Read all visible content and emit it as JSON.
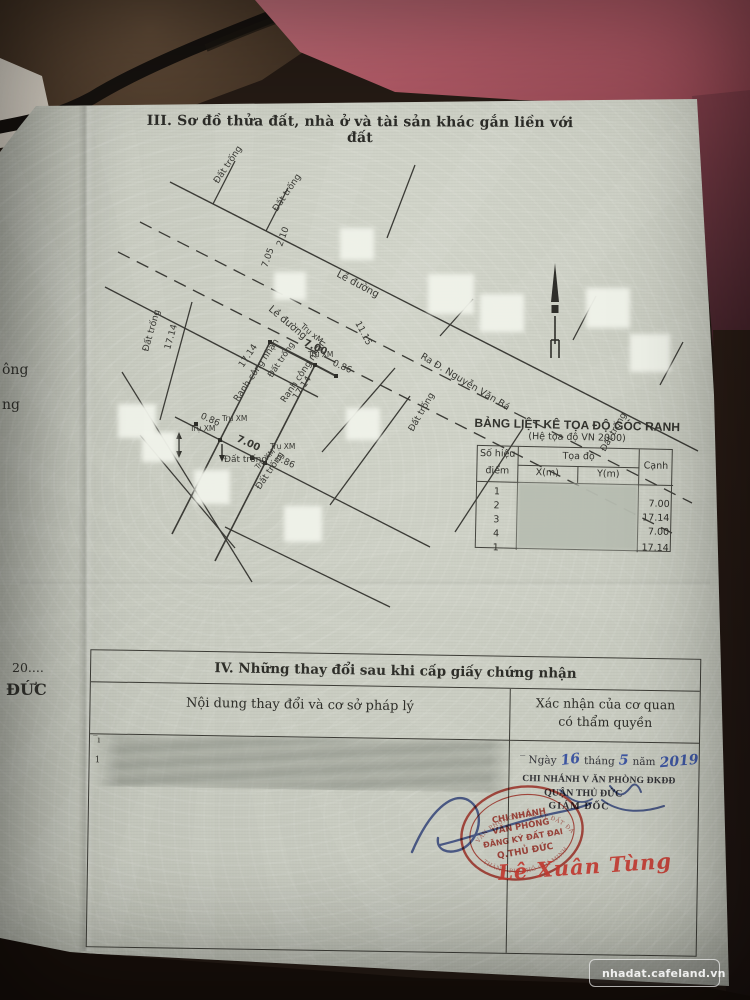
{
  "photo": {
    "watermark_label": "nhadat.cafeland.vn"
  },
  "document": {
    "section3_title": "III. Sơ đồ thửa đất, nhà ở và tài sản khác gắn liền với đất",
    "left_fragments": [
      {
        "t": "ông",
        "x": 2,
        "y": 362,
        "s": 14,
        "b": 0
      },
      {
        "t": "ng",
        "x": 2,
        "y": 397,
        "s": 14,
        "b": 0
      },
      {
        "t": "20....",
        "x": 12,
        "y": 660,
        "s": 12.5,
        "b": 0
      },
      {
        "t": "ĐỨC",
        "x": 6,
        "y": 680,
        "s": 16,
        "b": 1
      }
    ],
    "map": {
      "lines": [
        [
          170,
          182,
          698,
          451,
          0,
          1.4
        ],
        [
          213,
          204,
          235,
          161
        ],
        [
          266,
          231,
          288,
          188
        ],
        [
          415,
          165,
          387,
          238
        ],
        [
          440,
          336,
          473,
          299
        ],
        [
          573,
          340,
          596,
          296
        ],
        [
          660,
          385,
          683,
          342
        ],
        [
          140,
          222,
          692,
          503,
          1,
          1.3
        ],
        [
          118,
          252,
          672,
          533,
          1,
          1.3
        ],
        [
          105,
          287,
          318,
          397,
          0,
          1.4
        ],
        [
          192,
          302,
          160,
          420
        ],
        [
          122,
          372,
          252,
          582
        ],
        [
          140,
          435,
          235,
          548
        ],
        [
          270,
          342,
          172,
          534,
          0,
          1.6
        ],
        [
          270,
          342,
          315,
          365,
          0,
          2.2
        ],
        [
          315,
          365,
          215,
          561,
          0,
          1.6
        ],
        [
          175,
          417,
          430,
          547
        ],
        [
          315,
          365,
          336,
          376,
          0,
          2
        ],
        [
          225,
          527,
          390,
          607
        ],
        [
          395,
          368,
          322,
          452
        ],
        [
          410,
          396,
          330,
          505
        ],
        [
          523,
          428,
          455,
          532
        ]
      ],
      "posts": [
        [
          270,
          342
        ],
        [
          315,
          365
        ],
        [
          220,
          440
        ],
        [
          265,
          463
        ],
        [
          336,
          376
        ],
        [
          196,
          424
        ],
        [
          252,
          458
        ]
      ],
      "arrows": [
        {
          "x": 222,
          "y1": 444,
          "y2": 458,
          "h": "down"
        },
        {
          "x": 179,
          "y1": 436,
          "y2": 454,
          "h": "both"
        }
      ],
      "patches": [
        [
          340,
          228,
          34,
          32
        ],
        [
          274,
          272,
          32,
          28
        ],
        [
          428,
          274,
          46,
          40
        ],
        [
          480,
          294,
          44,
          38
        ],
        [
          586,
          288,
          44,
          40
        ],
        [
          630,
          334,
          40,
          38
        ],
        [
          118,
          404,
          38,
          34
        ],
        [
          142,
          432,
          34,
          30
        ],
        [
          194,
          470,
          36,
          34
        ],
        [
          346,
          408,
          34,
          32
        ],
        [
          284,
          506,
          38,
          36
        ]
      ],
      "labels": [
        {
          "t": "Đất trống",
          "x": 218,
          "y": 184,
          "r": -56,
          "s": 9
        },
        {
          "t": "Đất trống",
          "x": 277,
          "y": 212,
          "r": -56,
          "s": 9
        },
        {
          "t": "Lề đường",
          "x": 336,
          "y": 276,
          "r": 28,
          "s": 10
        },
        {
          "t": "Đất trống",
          "x": 148,
          "y": 352,
          "r": -74,
          "s": 9
        },
        {
          "t": "17.14",
          "x": 170,
          "y": 350,
          "r": -74,
          "s": 9
        },
        {
          "t": "Lề đường",
          "x": 268,
          "y": 310,
          "r": 40,
          "s": 10
        },
        {
          "t": "Trụ xM",
          "x": 300,
          "y": 327,
          "r": 40,
          "s": 8
        },
        {
          "t": "7.05",
          "x": 267,
          "y": 268,
          "r": -70,
          "s": 9
        },
        {
          "t": "2.10",
          "x": 282,
          "y": 247,
          "r": -70,
          "s": 9
        },
        {
          "t": "11.15",
          "x": 355,
          "y": 323,
          "r": 62,
          "s": 9
        },
        {
          "t": "Ra Đ. Nguyễn Văn Bá",
          "x": 420,
          "y": 358,
          "r": 31,
          "s": 9.5
        },
        {
          "t": "7.00",
          "x": 303,
          "y": 345,
          "r": 24,
          "s": 10,
          "b": 1
        },
        {
          "t": "Trụ XM",
          "x": 308,
          "y": 357,
          "r": 0,
          "s": 7.5
        },
        {
          "t": "0.86",
          "x": 332,
          "y": 365,
          "r": 24,
          "s": 9
        },
        {
          "t": "17.14",
          "x": 243,
          "y": 368,
          "r": -56,
          "s": 9
        },
        {
          "t": "Ranh công nhận",
          "x": 238,
          "y": 402,
          "r": -56,
          "s": 9
        },
        {
          "t": "Ranh công nhận",
          "x": 285,
          "y": 403,
          "r": -56,
          "s": 9
        },
        {
          "t": "17.14",
          "x": 297,
          "y": 400,
          "r": -56,
          "s": 9
        },
        {
          "t": "Đất trống",
          "x": 272,
          "y": 378,
          "r": -56,
          "s": 8.5
        },
        {
          "t": "Đất trống",
          "x": 260,
          "y": 490,
          "r": -56,
          "s": 9
        },
        {
          "t": "Đất trống",
          "x": 413,
          "y": 432,
          "r": -60,
          "s": 9
        },
        {
          "t": "Đất trống",
          "x": 605,
          "y": 452,
          "r": -60,
          "s": 9
        },
        {
          "t": "Đất trống",
          "x": 224,
          "y": 462,
          "r": 0,
          "s": 9
        },
        {
          "t": "7.00",
          "x": 236,
          "y": 441,
          "r": 24,
          "s": 10,
          "b": 1
        },
        {
          "t": "0.86",
          "x": 275,
          "y": 460,
          "r": 24,
          "s": 9
        },
        {
          "t": "0.86",
          "x": 200,
          "y": 418,
          "r": 24,
          "s": 9
        },
        {
          "t": "Trụ XM",
          "x": 222,
          "y": 421,
          "r": 0,
          "s": 7.5
        },
        {
          "t": "Trụ XM",
          "x": 190,
          "y": 431,
          "r": 0,
          "s": 7.5
        },
        {
          "t": "Trụ XM",
          "x": 270,
          "y": 449,
          "r": 0,
          "s": 7.5
        },
        {
          "t": "Trụ XM",
          "x": 258,
          "y": 470,
          "r": -46,
          "s": 7.5
        }
      ]
    },
    "coord_table": {
      "title": "BẢNG LIỆT KÊ TỌA ĐỘ GÓC RANH",
      "subtitle": "(Hệ tọa độ VN 2000)",
      "col_point_1": "Số hiệu",
      "col_point_2": "điểm",
      "col_coord": "Tọa độ",
      "col_x": "X(m)",
      "col_y": "Y(m)",
      "col_edge": "Cạnh",
      "points": [
        "1",
        "2",
        "3",
        "4",
        "1"
      ],
      "edges": [
        "7.00",
        "17.14",
        "7.00",
        "17.14"
      ]
    },
    "section4": {
      "title": "IV. Những thay đổi sau khi cấp giấy chứng nhận",
      "col_left": "Nội dung thay đổi và cơ sở pháp lý",
      "col_right_1": "Xác nhận của cơ quan",
      "col_right_2": "có thẩm quyền",
      "marks": [
        {
          "t": "‾ı",
          "x": 3,
          "y": 85
        },
        {
          "t": "1",
          "x": 5,
          "y": 105
        }
      ],
      "date": {
        "prefix": "‾ Ngày",
        "d": "16",
        "m_label": "tháng",
        "m": "5",
        "y_label": "năm",
        "y": "2019"
      },
      "office_line1": "CHI NHÁNH V ĂN PHÒNG ĐKĐĐ",
      "office_line2": "QUẬN THỦ ĐỨC",
      "office_line3": "GIÁM ĐỐC",
      "signature_name": "Lê Xuân Tùng",
      "stamp": {
        "line1": "CHI NHÁNH",
        "line2": "VĂN PHÒNG",
        "line3": "ĐĂNG KÝ ĐẤT ĐAI",
        "line4": "Q.THỦ ĐỨC",
        "ring_top": "VĂN PHÒNG ĐĂNG KÝ ĐẤT ĐAI",
        "ring_bottom": "THÀNH PHỐ HỒ CHÍ MINH"
      }
    }
  }
}
